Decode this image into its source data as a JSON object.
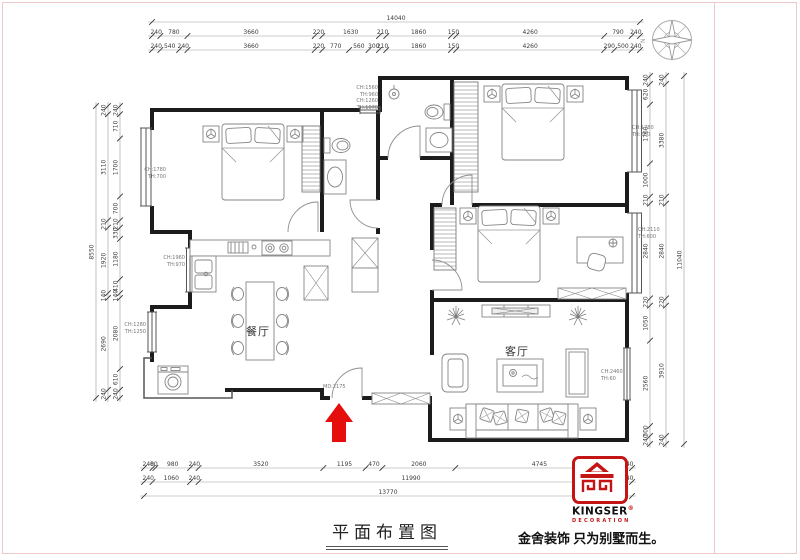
{
  "meta": {
    "drawing_title": "平面布置图",
    "slogan": "金舍装饰 只为别墅而生。"
  },
  "logo": {
    "brand": "KINGSER",
    "registered": "®",
    "subtitle": "DECORATION"
  },
  "compass": {
    "label": "N"
  },
  "rooms": [
    {
      "id": "dining",
      "label": "餐厅"
    },
    {
      "id": "living",
      "label": "客厅"
    }
  ],
  "entry": {
    "label": "MD:2175"
  },
  "window_annotations": [
    {
      "id": "left-bedroom-window",
      "lines": [
        "CH:1780",
        "TH:700"
      ]
    },
    {
      "id": "kitchen-window",
      "lines": [
        "CH:1960",
        "TH:970"
      ]
    },
    {
      "id": "dining-window",
      "lines": [
        "CH:1280",
        "TH:1250"
      ]
    },
    {
      "id": "top-middle-window",
      "lines": [
        "CH:1560",
        "TH:960",
        "CH:1260",
        "TH:1070"
      ]
    },
    {
      "id": "right-top-window",
      "lines": [
        "CH:1780",
        "TH:880"
      ]
    },
    {
      "id": "right-middle-window",
      "lines": [
        "CH:2110",
        "TH:600"
      ]
    },
    {
      "id": "living-right-window",
      "lines": [
        "CH:2460",
        "TH:60"
      ]
    }
  ],
  "dimensions": {
    "top": [
      [
        14040
      ],
      [
        240,
        780,
        3660,
        220,
        1630,
        210,
        1860,
        150,
        4260,
        790,
        240
      ],
      [
        240,
        540,
        240,
        3660,
        220,
        770,
        560,
        300,
        210,
        1860,
        150,
        4260,
        290,
        500,
        240
      ]
    ],
    "bottom": [
      [
        240,
        80,
        980,
        240,
        3520,
        1195,
        470,
        2060,
        4745,
        240
      ],
      [
        240,
        1060,
        240,
        11990,
        240
      ],
      [
        13770
      ]
    ],
    "left": [
      [
        8550
      ],
      [
        240,
        3110,
        210,
        1920,
        140,
        2690,
        240
      ],
      [
        240,
        710,
        1700,
        700,
        210,
        330,
        1180,
        410,
        140,
        2080,
        610,
        240
      ]
    ],
    "right": [
      [
        240,
        620,
        1760,
        1000,
        210,
        2840,
        220,
        1050,
        2560,
        300,
        240
      ],
      [
        240,
        3380,
        210,
        2840,
        220,
        3910,
        240
      ],
      [
        11040
      ]
    ]
  }
}
